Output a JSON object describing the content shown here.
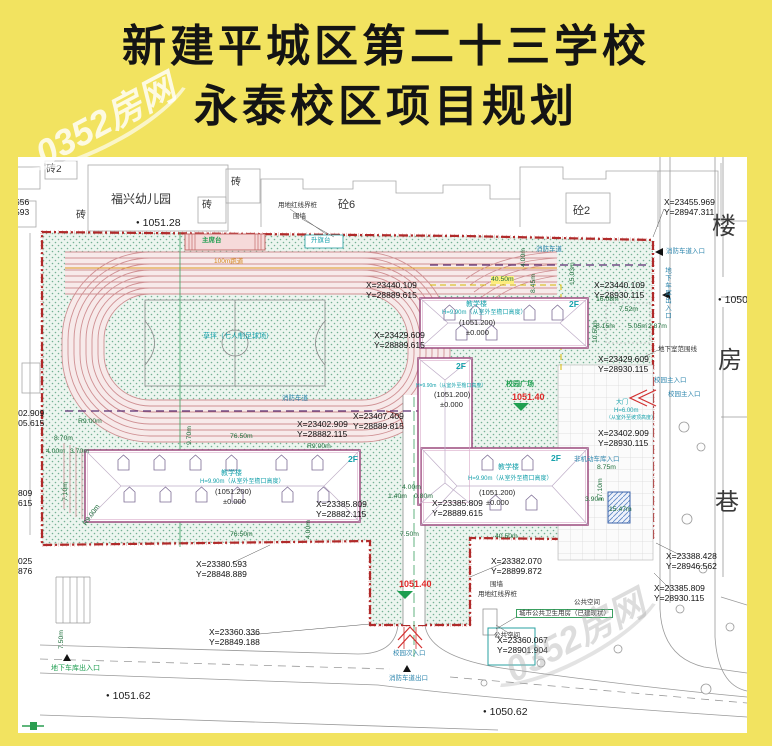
{
  "title": {
    "line1": "新建平城区第二十三学校",
    "line2": "永泰校区项目规划"
  },
  "watermark": {
    "brand": "0352房网"
  },
  "surroundings": {
    "kindergarten": "福兴幼儿园",
    "brick2": "砖2",
    "brick_a": "砖",
    "brick_b": "砖",
    "brick_c": "砖",
    "concrete6": "砼6",
    "concrete2": "砼2",
    "street": {
      "char1": "楼",
      "char2": "房",
      "char3": "巷"
    }
  },
  "elevations": {
    "e1": "1051.28",
    "e2": "1050.",
    "e3": "1051.62",
    "e4": "1050.62",
    "plaza": "1051.40",
    "south": "1051.40"
  },
  "sports": {
    "stand": "主席台",
    "flag_stage": "升旗台",
    "track": "100m跑道",
    "field": "草坪（七人制足球场）"
  },
  "site": {
    "red_line_marker_top": "用地红线界桩",
    "wall_top": "围墙",
    "red_line_marker_bottom": "用地红线界桩",
    "wall_bottom": "围墙",
    "basement_line": "地下室范围线",
    "fire_lane_top": "消防车道",
    "fire_lane_mid": "消防车道",
    "plaza_label": "校园广场",
    "public_space_1": "公共空间",
    "public_space_2": "公共空间",
    "toilet": "城市公共卫生用房（已建现状）"
  },
  "buildings": {
    "b1": {
      "name": "教学楼",
      "height": "H=9.90m（从室外至檐口高度）",
      "level": "(1051.200)",
      "zero": "±0.000",
      "floors": "2F"
    },
    "b2": {
      "height": "H=9.90m（从室外至檐口高度）",
      "level": "(1051.200)",
      "zero": "±0.000",
      "floors": "2F"
    },
    "b3": {
      "name": "教学楼",
      "height": "H=9.90m（从室外至檐口高度）",
      "level": "(1051.200)",
      "zero": "±0.000",
      "floors": "2F"
    },
    "b4": {
      "name": "教学楼",
      "height": "H=9.90m（从室外至檐口高度）",
      "level": "(1051.200)",
      "zero": "±0.000",
      "floors": "2F"
    },
    "bike_entry": "非机动车库入口"
  },
  "entrances": {
    "fire_in": "消防车道入口",
    "garage_right": "地下车库出入口",
    "main_1": "校园主入口",
    "main_2": "校园主入口",
    "gate": "大门",
    "gate_height": "H=6.00m",
    "gate_note": "（从室外至坡顶高度）",
    "side": "校园次入口",
    "fire_out": "消防车道出口",
    "garage_left": "地下车库出入口"
  },
  "coords": [
    {
      "x": "X=23455.969",
      "y": "Y=28947.311"
    },
    {
      "x": "X=23440.109",
      "y": "Y=28930.115"
    },
    {
      "x": "X=23440.109",
      "y": "Y=28889.615"
    },
    {
      "x": "X=23429.609",
      "y": "Y=28930.115"
    },
    {
      "x": "X=23429.609",
      "y": "Y=28889.615"
    },
    {
      "x": "X=23402.909",
      "y": "Y=28930.115"
    },
    {
      "x": "X=23402.909",
      "y": "Y=28882.115"
    },
    {
      "x": "X=23407.409",
      "y": "Y=28889.815"
    },
    {
      "x": "X=23385.809",
      "y": "Y=28882.115"
    },
    {
      "x": "X=23385.809",
      "y": "Y=28889.615"
    },
    {
      "x": "X=23380.593",
      "y": "Y=28848.889"
    },
    {
      "x": "X=23360.336",
      "y": "Y=28849.188"
    },
    {
      "x": "X=23382.070",
      "y": "Y=28899.872"
    },
    {
      "x": "X=23360.067",
      "y": "Y=28901.904"
    },
    {
      "x": "X=23388.428",
      "y": "Y=28946.562"
    },
    {
      "x": "X=23385.809",
      "y": "Y=28930.115"
    },
    {
      "x": "23402.909",
      "y": "28805.615"
    },
    {
      "x": "809",
      "y": "615"
    },
    {
      "x": "025",
      "y": "876"
    },
    {
      "x": "556",
      "y": "593"
    }
  ],
  "dims": [
    "40.50m",
    "4.00m",
    "8.45m",
    "15.03m",
    "16.08m",
    "7.52m",
    "10.50m",
    "8.15m",
    "5.05m",
    "2.87m",
    "76.50m",
    "76.50m",
    "4.00m",
    "R9.00m",
    "R9.00m",
    "R9.00m",
    "8.70m",
    "4.00m",
    "3.70m",
    "7.10m",
    "9.70m",
    "4.00m",
    "1.40m",
    "0.80m",
    "7.50m",
    "17.10m",
    "8.75m",
    "3.90m",
    "15.47m",
    "40.50m",
    "7.50m"
  ]
}
